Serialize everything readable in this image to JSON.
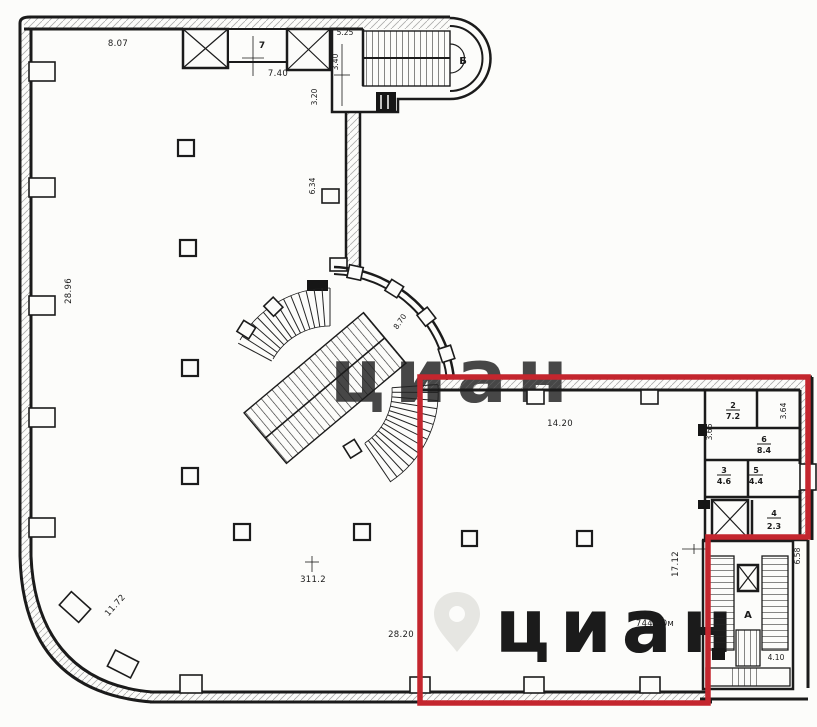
{
  "colors": {
    "ink": "#1b1b1b",
    "highlight_red": "#c4262e",
    "paper": "#fcfcfa",
    "watermark_gray": "#e9e9e5"
  },
  "watermark": {
    "text": "циан",
    "logo": "map-pin-icon"
  },
  "dims": {
    "top_left_wall": "8.07",
    "room7_width": "7.40",
    "vestibule_top": "5.25",
    "vestibule_mid": "3.40",
    "vestibule_low": "3.20",
    "passage": "6.34",
    "left_wall": "28.96",
    "arc_stair": "8.70",
    "hall_top": "14.20",
    "partition_left": "3.66",
    "partition_right": "3.64",
    "stairwell_left": "17.12",
    "stairwell_right": "6.58",
    "stairwell_bottom": "4.10",
    "bottom_wall": "28.20",
    "curved_wall": "11.72",
    "area_hall": "311.2",
    "area_total": "744.50м"
  },
  "rooms": {
    "room7": "7",
    "stair_top": "Б",
    "stair_main": "А",
    "r2": {
      "n": "2",
      "a": "7.2"
    },
    "r6": {
      "n": "6",
      "a": "8.4"
    },
    "r3": {
      "n": "3",
      "a": "4.6"
    },
    "r5": {
      "n": "5",
      "a": "4.4"
    },
    "r4": {
      "n": "4",
      "a": "2.3"
    }
  }
}
